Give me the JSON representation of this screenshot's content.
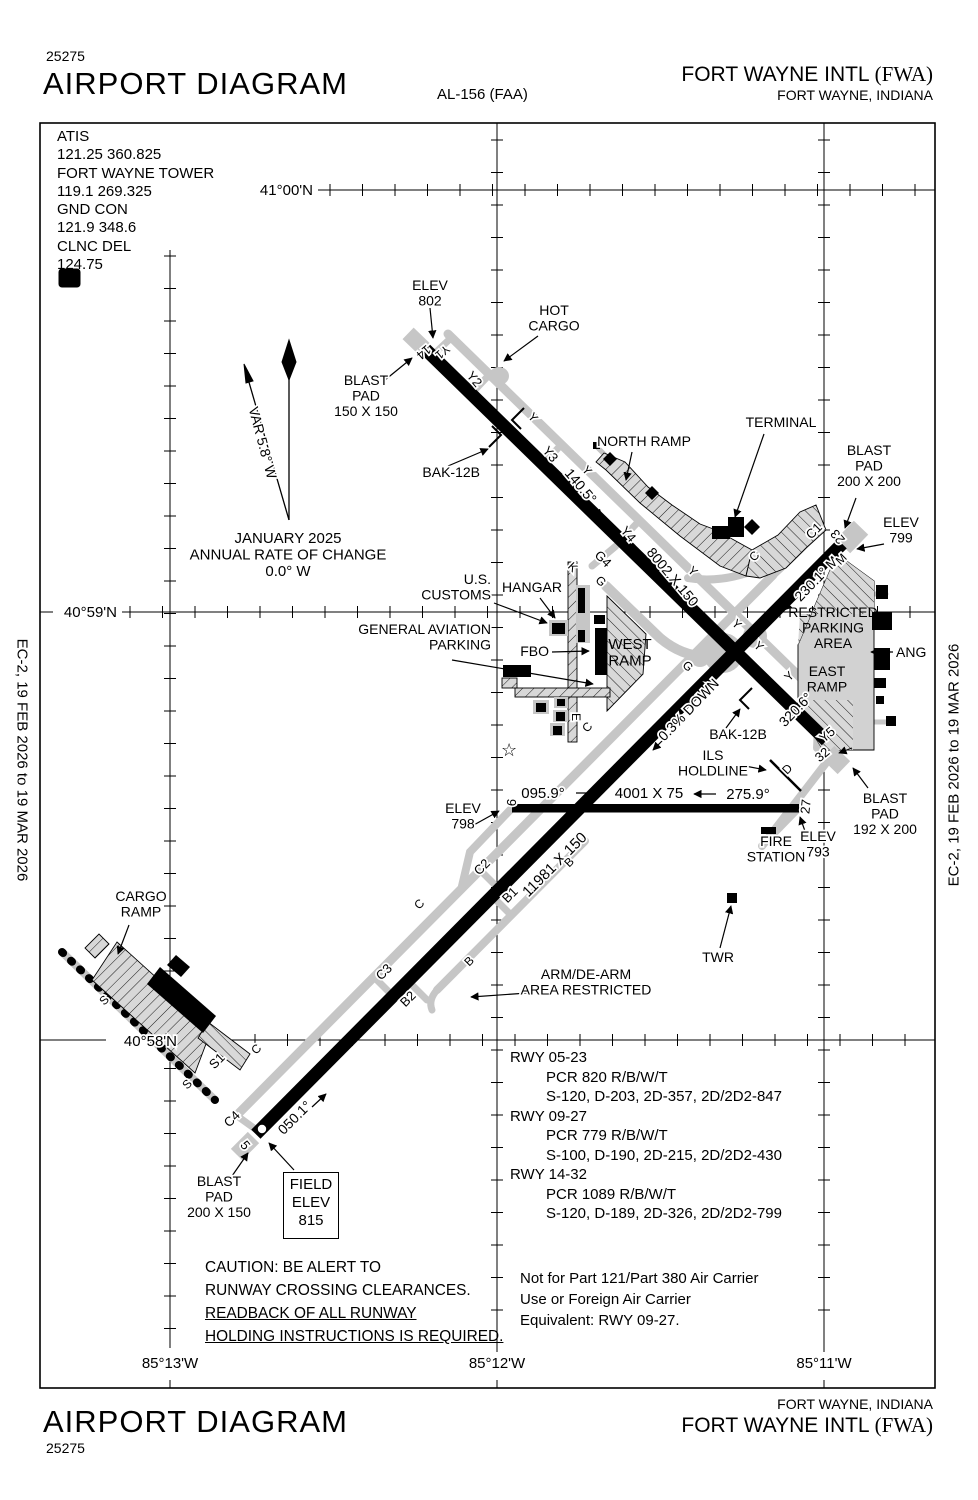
{
  "header": {
    "chart_number": "25275",
    "title": "AIRPORT DIAGRAM",
    "procedure_id": "AL-156 (FAA)",
    "airport_name": "FORT WAYNE INTL ",
    "airport_code": "(FWA)",
    "city_state": "FORT WAYNE, INDIANA"
  },
  "footer": {
    "chart_number": "25275",
    "title": "AIRPORT DIAGRAM",
    "airport_name": "FORT WAYNE INTL ",
    "airport_code": "(FWA)",
    "city_state": "FORT WAYNE, INDIANA"
  },
  "edge_note": "EC-2,  19 FEB 2026  to  19 MAR 2026",
  "frequencies": {
    "lines": [
      "ATIS",
      "121.25  360.825",
      "FORT WAYNE TOWER",
      "119.1  269.325",
      "GND CON",
      "121.9  348.6",
      "CLNC DEL",
      "124.75"
    ]
  },
  "field_elev": {
    "lines": [
      "FIELD",
      "ELEV",
      "815"
    ]
  },
  "runway_data": {
    "lines": [
      {
        "t": "RWY 05-23",
        "i": 0
      },
      {
        "t": "PCR 820 R/B/W/T",
        "i": 1
      },
      {
        "t": "S-120, D-203, 2D-357, 2D/2D2-847",
        "i": 1
      },
      {
        "t": "RWY 09-27",
        "i": 0
      },
      {
        "t": "PCR 779 R/B/W/T",
        "i": 1
      },
      {
        "t": "S-100, D-190, 2D-215, 2D/2D2-430",
        "i": 1
      },
      {
        "t": "RWY 14-32",
        "i": 0
      },
      {
        "t": "PCR 1089 R/B/W/T",
        "i": 1
      },
      {
        "t": "S-120, D-189, 2D-326, 2D/2D2-799",
        "i": 1
      }
    ]
  },
  "caution": {
    "lines": [
      {
        "t": "CAUTION:  BE ALERT TO",
        "u": false
      },
      {
        "t": "RUNWAY CROSSING CLEARANCES.",
        "u": false
      },
      {
        "t": "READBACK OF ALL RUNWAY",
        "u": true
      },
      {
        "t": "HOLDING INSTRUCTIONS IS REQUIRED.",
        "u": true
      }
    ]
  },
  "carrier_note": {
    "lines": [
      "Not for Part 121/Part 380 Air Carrier",
      "Use or Foreign Air Carrier",
      "Equivalent: RWY 09-27."
    ]
  },
  "map_labels": [
    {
      "n": "lat-41-00n",
      "t": "41°00'N",
      "x": 313,
      "y": 195,
      "a": "e",
      "s": 15
    },
    {
      "n": "lat-40-59n",
      "t": "40°59'N",
      "x": 117,
      "y": 617,
      "a": "e",
      "s": 15
    },
    {
      "n": "lat-40-58n",
      "t": "40°58'N",
      "x": 177,
      "y": 1046,
      "a": "e",
      "s": 15
    },
    {
      "n": "lon-85-13w",
      "t": "85°13'W",
      "x": 170,
      "y": 1368,
      "s": 15
    },
    {
      "n": "lon-85-12w",
      "t": "85°12'W",
      "x": 497,
      "y": 1368,
      "s": 15
    },
    {
      "n": "lon-85-11w",
      "t": "85°11'W",
      "x": 824,
      "y": 1368,
      "s": 15
    },
    {
      "n": "var-label",
      "t": "VAR 5.8° W",
      "x": 258,
      "y": 444,
      "r": 75,
      "s": 14
    },
    {
      "n": "mag-var-note",
      "lines": [
        "JANUARY 2025",
        "ANNUAL RATE OF CHANGE",
        "0.0° W"
      ],
      "x": 288,
      "y": 543,
      "s": 15
    },
    {
      "n": "hold-shield-d",
      "t": "D",
      "x": 69,
      "y": 284,
      "s": 13,
      "b": true,
      "fill": "#fff",
      "halo": false
    },
    {
      "n": "elev-802",
      "lines": [
        "ELEV",
        "802"
      ],
      "x": 430,
      "y": 290
    },
    {
      "n": "hot-cargo",
      "lines": [
        "HOT",
        "CARGO"
      ],
      "x": 554,
      "y": 315
    },
    {
      "n": "blast-pad-14",
      "lines": [
        "BLAST",
        "PAD",
        "150 X 150"
      ],
      "x": 366,
      "y": 385
    },
    {
      "n": "bak-12b-west",
      "t": "BAK-12B",
      "x": 480,
      "y": 477,
      "a": "e"
    },
    {
      "n": "north-ramp",
      "t": "NORTH RAMP",
      "x": 644,
      "y": 446
    },
    {
      "n": "terminal",
      "t": "TERMINAL",
      "x": 781,
      "y": 427
    },
    {
      "n": "blast-pad-23",
      "lines": [
        "BLAST",
        "PAD",
        "200 X 200"
      ],
      "x": 869,
      "y": 455
    },
    {
      "n": "elev-799",
      "lines": [
        "ELEV",
        "799"
      ],
      "x": 901,
      "y": 527
    },
    {
      "n": "hdg-140-5",
      "t": "140.5°",
      "x": 577,
      "y": 489,
      "r": 50
    },
    {
      "n": "dim-rwy-14-32",
      "t": "8002 X 150",
      "x": 669,
      "y": 580,
      "r": 50
    },
    {
      "n": "hdg-230-1",
      "t": "230.1° M",
      "x": 820,
      "y": 582,
      "r": -46
    },
    {
      "n": "us-customs",
      "lines": [
        "U.S.",
        "CUSTOMS"
      ],
      "x": 491,
      "y": 584,
      "a": "e"
    },
    {
      "n": "hangar",
      "t": "HANGAR",
      "x": 532,
      "y": 592
    },
    {
      "n": "general-aviation-parking",
      "lines": [
        "GENERAL AVIATION",
        "PARKING"
      ],
      "x": 491,
      "y": 634,
      "a": "e"
    },
    {
      "n": "fbo",
      "t": "FBO",
      "x": 549,
      "y": 656,
      "a": "e"
    },
    {
      "n": "west-ramp",
      "lines": [
        "WEST",
        "RAMP"
      ],
      "x": 630,
      "y": 649,
      "s": 15,
      "halo": false
    },
    {
      "n": "restricted-parking-area",
      "lines": [
        "RESTRICTED",
        "PARKING",
        "AREA"
      ],
      "x": 833,
      "y": 617,
      "halo": false
    },
    {
      "n": "ang",
      "t": "ANG",
      "x": 896,
      "y": 657,
      "a": "s"
    },
    {
      "n": "east-ramp",
      "lines": [
        "EAST",
        "RAMP"
      ],
      "x": 827,
      "y": 676,
      "halo": false
    },
    {
      "n": "hdg-320-6",
      "t": "320.6°",
      "x": 799,
      "y": 713,
      "r": -46
    },
    {
      "n": "slope-0-3-down",
      "t": "0.3% DOWN",
      "x": 692,
      "y": 713,
      "r": -46
    },
    {
      "n": "bak-12b-east",
      "t": "BAK-12B",
      "x": 738,
      "y": 739
    },
    {
      "n": "ils-holdline",
      "lines": [
        "ILS",
        "HOLDLINE"
      ],
      "x": 713,
      "y": 760
    },
    {
      "n": "dim-rwy-09-27",
      "t": "4001 X 75",
      "x": 649,
      "y": 798,
      "s": 15
    },
    {
      "n": "hdg-095-9",
      "t": "095.9°",
      "x": 543,
      "y": 798,
      "s": 15
    },
    {
      "n": "hdg-275-9",
      "t": "275.9°",
      "x": 748,
      "y": 799,
      "s": 15
    },
    {
      "n": "elev-798",
      "lines": [
        "ELEV",
        "798"
      ],
      "x": 463,
      "y": 813
    },
    {
      "n": "elev-793",
      "lines": [
        "ELEV",
        "793"
      ],
      "x": 818,
      "y": 841
    },
    {
      "n": "blast-pad-32",
      "lines": [
        "BLAST",
        "PAD",
        "192 X 200"
      ],
      "x": 885,
      "y": 803
    },
    {
      "n": "fire-station",
      "lines": [
        "FIRE",
        "STATION"
      ],
      "x": 776,
      "y": 846
    },
    {
      "n": "dim-rwy-05-23",
      "t": "11981 X 150",
      "x": 558,
      "y": 868,
      "r": -45,
      "s": 15
    },
    {
      "n": "twr",
      "t": "TWR",
      "x": 718,
      "y": 962
    },
    {
      "n": "arm-de-arm",
      "lines": [
        "ARM/DE-ARM",
        "AREA RESTRICTED"
      ],
      "x": 586,
      "y": 979
    },
    {
      "n": "cargo-ramp",
      "lines": [
        "CARGO",
        "RAMP"
      ],
      "x": 141,
      "y": 901
    },
    {
      "n": "hdg-050-1",
      "t": "050.1°",
      "x": 298,
      "y": 1121,
      "r": -45
    },
    {
      "n": "blast-pad-5",
      "lines": [
        "BLAST",
        "PAD",
        "200 X 150"
      ],
      "x": 219,
      "y": 1186
    },
    {
      "n": "rwy-num-14",
      "t": "14",
      "x": 421,
      "y": 349,
      "r": 140,
      "s": 13
    },
    {
      "n": "rwy-num-23",
      "t": "23",
      "x": 841,
      "y": 534,
      "r": 230,
      "s": 13
    },
    {
      "n": "rwy-num-32",
      "t": "32",
      "x": 825,
      "y": 758,
      "r": 320,
      "s": 13
    },
    {
      "n": "rwy-num-5",
      "t": "5",
      "x": 242,
      "y": 1148,
      "r": 50,
      "s": 13
    },
    {
      "n": "rwy-num-9",
      "t": "9",
      "x": 507,
      "y": 802,
      "r": 96,
      "s": 13
    },
    {
      "n": "rwy-num-27",
      "t": "27",
      "x": 810,
      "y": 807,
      "r": 276,
      "s": 13
    },
    {
      "n": "twy-y1",
      "t": "Y1",
      "x": 440,
      "y": 349,
      "r": 140,
      "s": 12
    },
    {
      "n": "twy-y2",
      "t": "Y2",
      "x": 471,
      "y": 382,
      "r": 50,
      "s": 13
    },
    {
      "n": "twy-y-a",
      "t": "Y",
      "x": 530,
      "y": 420,
      "r": 50,
      "s": 12
    },
    {
      "n": "twy-y3",
      "t": "Y3",
      "x": 547,
      "y": 457,
      "r": 50,
      "s": 13
    },
    {
      "n": "twy-y-b",
      "t": "Y",
      "x": 584,
      "y": 473,
      "r": 50,
      "s": 12
    },
    {
      "n": "twy-y4",
      "t": "Y4",
      "x": 625,
      "y": 537,
      "r": 50,
      "s": 13
    },
    {
      "n": "twy-k",
      "t": "K",
      "x": 570,
      "y": 570,
      "r": 45,
      "s": 12
    },
    {
      "n": "twy-g4",
      "t": "G4",
      "x": 600,
      "y": 562,
      "r": 45,
      "s": 13
    },
    {
      "n": "twy-g-a",
      "t": "G",
      "x": 598,
      "y": 584,
      "r": 45,
      "s": 12
    },
    {
      "n": "twy-y-c",
      "t": "Y",
      "x": 690,
      "y": 574,
      "r": 45,
      "s": 12
    },
    {
      "n": "twy-c-a",
      "t": "C",
      "x": 757,
      "y": 559,
      "r": -45,
      "s": 12
    },
    {
      "n": "twy-c1",
      "t": "C1",
      "x": 817,
      "y": 534,
      "r": -45,
      "s": 13
    },
    {
      "n": "twy-m",
      "t": "M",
      "x": 844,
      "y": 562,
      "r": -45,
      "s": 12
    },
    {
      "n": "twy-g-b",
      "t": "G",
      "x": 685,
      "y": 669,
      "r": 45,
      "s": 12
    },
    {
      "n": "twy-y-d",
      "t": "Y",
      "x": 734,
      "y": 627,
      "r": 45,
      "s": 12
    },
    {
      "n": "twy-y-e",
      "t": "Y",
      "x": 756,
      "y": 649,
      "r": 45,
      "s": 12
    },
    {
      "n": "twy-y-f",
      "t": "Y",
      "x": 792,
      "y": 679,
      "r": -45,
      "s": 12
    },
    {
      "n": "twy-y5",
      "t": "Y5",
      "x": 830,
      "y": 738,
      "r": -40,
      "s": 13
    },
    {
      "n": "twy-d",
      "t": "D",
      "x": 790,
      "y": 772,
      "r": -45,
      "s": 12
    },
    {
      "n": "twy-e",
      "t": "E",
      "x": 572,
      "y": 717,
      "r": 90,
      "s": 12
    },
    {
      "n": "twy-c-b",
      "t": "C",
      "x": 590,
      "y": 730,
      "r": -45,
      "s": 12
    },
    {
      "n": "twy-b-a",
      "t": "B",
      "x": 572,
      "y": 865,
      "r": -45,
      "s": 12
    },
    {
      "n": "twy-b1",
      "t": "B1",
      "x": 513,
      "y": 898,
      "r": -45,
      "s": 13
    },
    {
      "n": "twy-c2",
      "t": "C2",
      "x": 485,
      "y": 870,
      "r": -45,
      "s": 13
    },
    {
      "n": "twy-c-c",
      "t": "C",
      "x": 422,
      "y": 907,
      "r": -45,
      "s": 12
    },
    {
      "n": "twy-b-b",
      "t": "B",
      "x": 472,
      "y": 964,
      "r": -45,
      "s": 12
    },
    {
      "n": "twy-c3",
      "t": "C3",
      "x": 387,
      "y": 975,
      "r": -45,
      "s": 13
    },
    {
      "n": "twy-b2",
      "t": "B2",
      "x": 411,
      "y": 1002,
      "r": -45,
      "s": 13
    },
    {
      "n": "twy-c-d",
      "t": "C",
      "x": 259,
      "y": 1052,
      "r": -45,
      "s": 12
    },
    {
      "n": "twy-s1",
      "t": "S1",
      "x": 220,
      "y": 1064,
      "r": -45,
      "s": 13
    },
    {
      "n": "twy-s-a",
      "t": "S",
      "x": 107,
      "y": 1003,
      "r": -45,
      "s": 12
    },
    {
      "n": "twy-s-b",
      "t": "S",
      "x": 190,
      "y": 1087,
      "r": -45,
      "s": 12
    },
    {
      "n": "twy-c4",
      "t": "C4",
      "x": 235,
      "y": 1122,
      "r": -45,
      "s": 13
    },
    {
      "n": "airport-beacon",
      "t": "☆",
      "x": 509,
      "y": 756,
      "s": 18,
      "halo": false
    }
  ]
}
